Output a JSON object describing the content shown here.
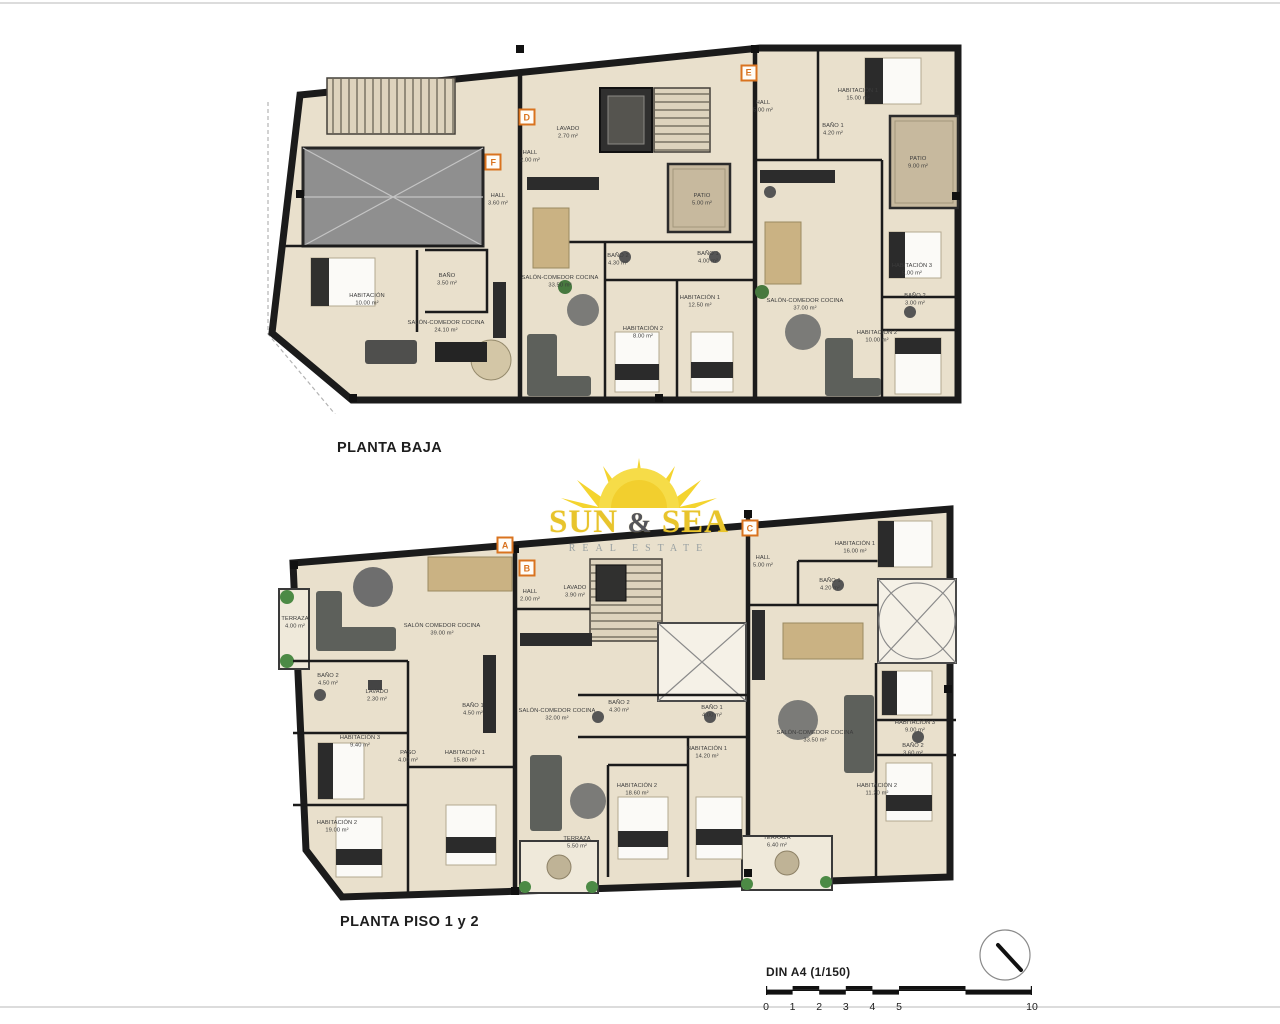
{
  "page": {
    "background": "#ffffff"
  },
  "colors": {
    "marker_orange": "#d9731f",
    "logo_yellow": "#e8c42c",
    "floor_beige": "#e9e0cc",
    "patio_tan": "#c7b99e",
    "wall_black": "#1b1b1b"
  },
  "logo": {
    "word1": "SUN",
    "amp": "&",
    "word2": "SEA",
    "subtitle": "REAL ESTATE",
    "icon": "sun-icon"
  },
  "footer": {
    "scale_label": "DIN A4 (1/150)",
    "scale_ticks": [
      {
        "t": "0",
        "p": 0
      },
      {
        "t": "1",
        "p": 10
      },
      {
        "t": "2",
        "p": 20
      },
      {
        "t": "3",
        "p": 30
      },
      {
        "t": "4",
        "p": 40
      },
      {
        "t": "5",
        "p": 50
      },
      {
        "t": "10",
        "p": 100
      }
    ],
    "compass": "north-arrow"
  },
  "plans": [
    {
      "id": "planta-baja",
      "title": "PLANTA BAJA",
      "markers": [
        {
          "letter": "F",
          "x": 32.6,
          "y": 32.3
        },
        {
          "letter": "D",
          "x": 37.4,
          "y": 20.2
        },
        {
          "letter": "E",
          "x": 69.1,
          "y": 8.3
        }
      ],
      "rooms": [
        {
          "name": "HABITACIÓN",
          "area": "10.00 m²",
          "x": 14.6,
          "y": 69.4
        },
        {
          "name": "BAÑO",
          "area": "3.50 m²",
          "x": 26.0,
          "y": 64.0
        },
        {
          "name": "SALÓN-COMEDOR COCINA",
          "area": "24.10 m²",
          "x": 25.9,
          "y": 76.6
        },
        {
          "name": "HALL",
          "area": "3.60 m²",
          "x": 33.3,
          "y": 42.5
        },
        {
          "name": "HALL",
          "area": "2.00 m²",
          "x": 37.9,
          "y": 30.9
        },
        {
          "name": "LAVADO",
          "area": "2.70 m²",
          "x": 43.3,
          "y": 24.5
        },
        {
          "name": "SALÓN-COMEDOR COCINA",
          "area": "33.50 m²",
          "x": 42.1,
          "y": 64.5
        },
        {
          "name": "BAÑO 2",
          "area": "4.30 m²",
          "x": 50.4,
          "y": 58.6
        },
        {
          "name": "BAÑO 1",
          "area": "4.00 m²",
          "x": 63.3,
          "y": 58.1
        },
        {
          "name": "HABITACIÓN 1",
          "area": "12.50 m²",
          "x": 62.1,
          "y": 69.9
        },
        {
          "name": "HABITACIÓN 2",
          "area": "8.00 m²",
          "x": 54.0,
          "y": 78.2
        },
        {
          "name": "PATIO",
          "area": "5.00 m²",
          "x": 62.4,
          "y": 42.5
        },
        {
          "name": "HALL",
          "area": "5.00 m²",
          "x": 71.1,
          "y": 17.5
        },
        {
          "name": "HABITACIÓN 1",
          "area": "15.00 m²",
          "x": 84.7,
          "y": 14.2
        },
        {
          "name": "BAÑO 1",
          "area": "4.20 m²",
          "x": 81.1,
          "y": 23.7
        },
        {
          "name": "PATIO",
          "area": "9.00 m²",
          "x": 93.3,
          "y": 32.5
        },
        {
          "name": "SALÓN-COMEDOR COCINA",
          "area": "37.00 m²",
          "x": 77.1,
          "y": 70.7
        },
        {
          "name": "HABITACIÓN 3",
          "area": "5.00 m²",
          "x": 92.4,
          "y": 61.3
        },
        {
          "name": "BAÑO 2",
          "area": "3.00 m²",
          "x": 92.9,
          "y": 69.4
        },
        {
          "name": "HABITACIÓN 2",
          "area": "10.00 m²",
          "x": 87.4,
          "y": 79.3
        }
      ]
    },
    {
      "id": "planta-piso-1-y-2",
      "title": "PLANTA PISO 1 y 2",
      "markers": [
        {
          "letter": "A",
          "x": 33.4,
          "y": 10.0
        },
        {
          "letter": "B",
          "x": 36.6,
          "y": 15.8
        },
        {
          "letter": "C",
          "x": 69.4,
          "y": 5.8
        }
      ],
      "rooms": [
        {
          "name": "TERRAZA",
          "area": "4.00 m²",
          "x": 2.5,
          "y": 29.5
        },
        {
          "name": "SALÓN COMEDOR COCINA",
          "area": "39.00 m²",
          "x": 24.1,
          "y": 31.3
        },
        {
          "name": "BAÑO 2",
          "area": "4.50 m²",
          "x": 7.4,
          "y": 43.8
        },
        {
          "name": "LAVADO",
          "area": "2.30 m²",
          "x": 14.6,
          "y": 47.8
        },
        {
          "name": "HABITACIÓN 3",
          "area": "9.40 m²",
          "x": 12.1,
          "y": 59.3
        },
        {
          "name": "PASO",
          "area": "4.00 m²",
          "x": 19.1,
          "y": 63.0
        },
        {
          "name": "HABITACIÓN 1",
          "area": "15.80 m²",
          "x": 27.5,
          "y": 63.0
        },
        {
          "name": "HABITACIÓN 2",
          "area": "19.00 m²",
          "x": 8.7,
          "y": 80.5
        },
        {
          "name": "HALL",
          "area": "2.00 m²",
          "x": 37.1,
          "y": 22.8
        },
        {
          "name": "LAVADO",
          "area": "3.90 m²",
          "x": 43.7,
          "y": 21.8
        },
        {
          "name": "BAÑO 1",
          "area": "4.50 m²",
          "x": 28.7,
          "y": 51.3
        },
        {
          "name": "SALÓN-COMEDOR COCINA",
          "area": "32.00 m²",
          "x": 41.0,
          "y": 52.5
        },
        {
          "name": "BAÑO 2",
          "area": "4.30 m²",
          "x": 50.1,
          "y": 50.5
        },
        {
          "name": "BAÑO 1",
          "area": "4.00 m²",
          "x": 63.8,
          "y": 51.8
        },
        {
          "name": "HABITACIÓN 1",
          "area": "14.20 m²",
          "x": 63.1,
          "y": 62.0
        },
        {
          "name": "HABITACIÓN 2",
          "area": "18.60 m²",
          "x": 52.8,
          "y": 71.3
        },
        {
          "name": "TERRAZA",
          "area": "5.50 m²",
          "x": 44.0,
          "y": 84.5
        },
        {
          "name": "TERRAZA",
          "area": "6.40 m²",
          "x": 73.4,
          "y": 84.3
        },
        {
          "name": "HALL",
          "area": "5.00 m²",
          "x": 71.3,
          "y": 14.3
        },
        {
          "name": "HABITACIÓN 1",
          "area": "16.00 m²",
          "x": 84.9,
          "y": 10.8
        },
        {
          "name": "BAÑO 1",
          "area": "4.20 m²",
          "x": 81.2,
          "y": 20.0
        },
        {
          "name": "SALÓN-COMEDOR COCINA",
          "area": "33.50 m²",
          "x": 79.0,
          "y": 58.0
        },
        {
          "name": "HABITACIÓN 3",
          "area": "9.00 m²",
          "x": 93.7,
          "y": 55.5
        },
        {
          "name": "BAÑO 2",
          "area": "3.60 m²",
          "x": 93.4,
          "y": 61.3
        },
        {
          "name": "HABITACIÓN 2",
          "area": "11.20 m²",
          "x": 88.1,
          "y": 71.3
        }
      ]
    }
  ]
}
